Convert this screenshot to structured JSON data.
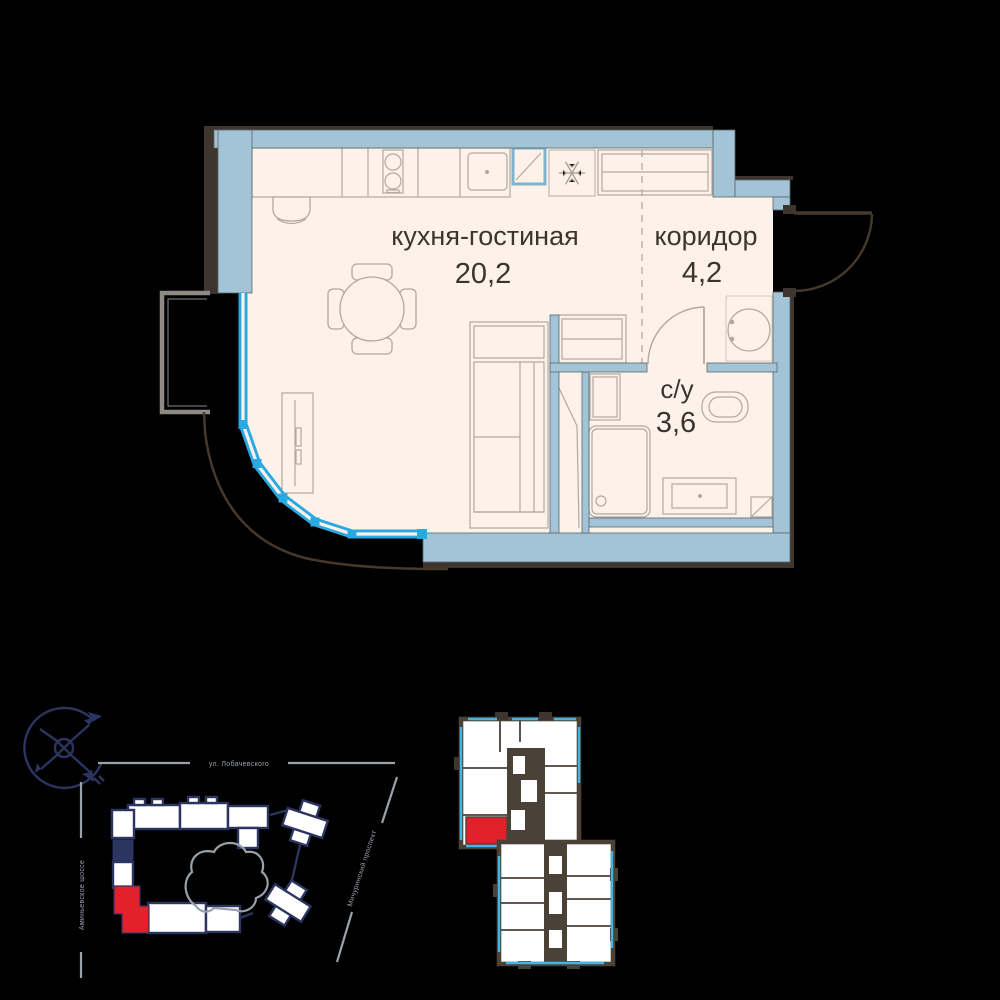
{
  "floor_plan": {
    "rooms": [
      {
        "name": "кухня-гостиная",
        "area": "20,2"
      },
      {
        "name": "коридор",
        "area": "4,2"
      },
      {
        "name": "с/у",
        "area": "3,6"
      }
    ]
  },
  "site_plan": {
    "street_top": "ул. Лобачевского",
    "street_left": "Аминьевское шоссе",
    "street_right": "Мичуринский проспект"
  },
  "icons": {
    "compass": "compass-rose",
    "fridge": "snowflake"
  },
  "colors": {
    "wall_blue": "#a2c4d6",
    "window_blue": "#29a9e1",
    "floor_cream": "#fdf2ea",
    "furniture_line": "#b3a89f",
    "outline_dark": "#3e362e",
    "door_brown": "#46392b",
    "site_navy": "#2b3560",
    "street_gray": "#9aa0ac",
    "highlight_red": "#e3212b",
    "plate_dark": "#4a4237",
    "plate_cyan": "#41b6e6"
  }
}
